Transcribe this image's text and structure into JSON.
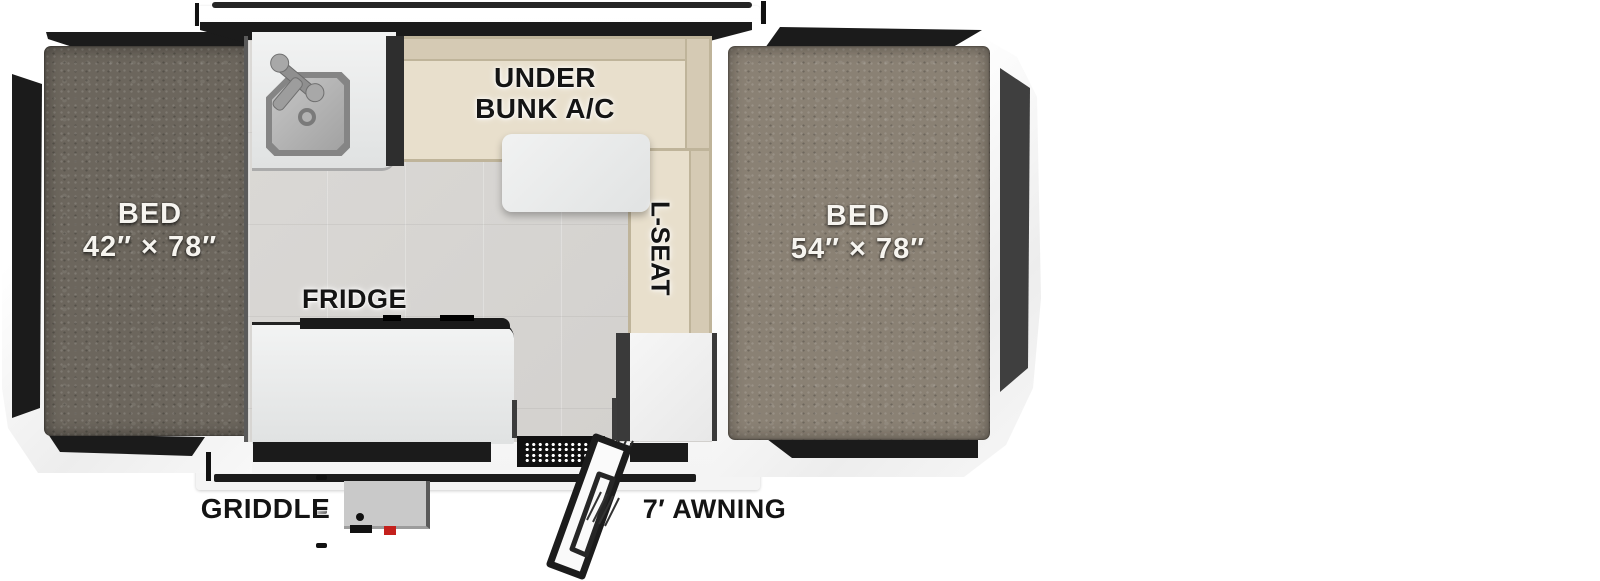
{
  "floorplan": {
    "left_bed": {
      "label": "BED",
      "size": "42″ × 78″"
    },
    "right_bed": {
      "label": "BED",
      "size": "54″ × 78″"
    },
    "dinette": {
      "ac_line1": "UNDER",
      "ac_line2": "BUNK A/C",
      "seat_label": "L-SEAT"
    },
    "kitchen": {
      "fridge": "FRIDGE",
      "griddle": "GRIDDLE"
    },
    "exterior": {
      "awning": "7′ AWNING"
    },
    "colors": {
      "left_mattress": "#6c665d",
      "right_mattress": "#8a8174",
      "bench_beige": "#e8dfcc",
      "bench_trim": "#bfb49a",
      "floor_tile": "#d7d5d2",
      "accent_black": "#1b1b1b",
      "panel_gray": "#3f3f3f",
      "griddle_red": "#c4201c"
    }
  }
}
